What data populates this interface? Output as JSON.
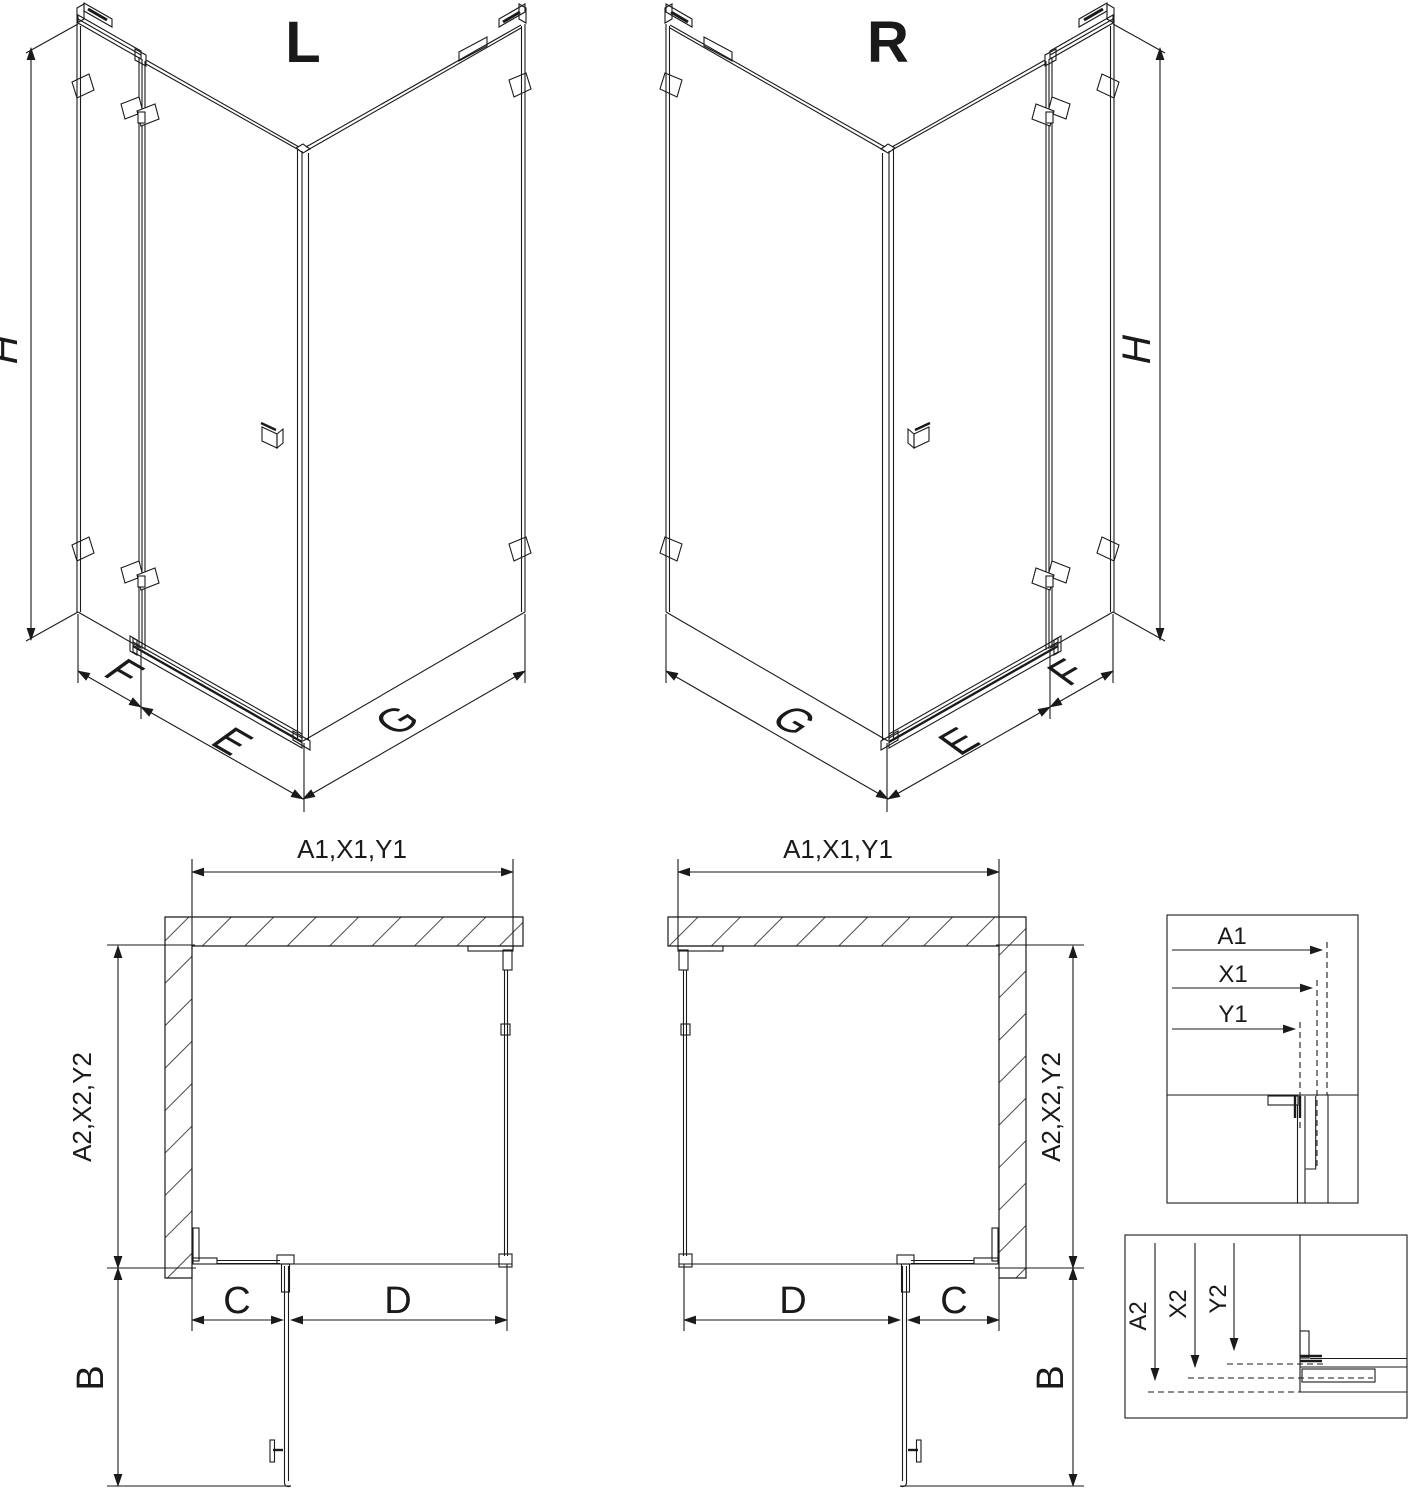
{
  "drawing": {
    "left_view_label": "L",
    "right_view_label": "R",
    "dim_height": "H",
    "dim_fixed_panel": "F",
    "dim_door": "E",
    "dim_side_panel": "G",
    "plan_width_group": "A1,X1,Y1",
    "plan_depth_group": "A2,X2,Y2",
    "dim_c": "C",
    "dim_d": "D",
    "dim_b": "B",
    "detail_a1": "A1",
    "detail_x1": "X1",
    "detail_y1": "Y1",
    "detail_a2": "A2",
    "detail_x2": "X2",
    "detail_y2": "Y2"
  },
  "colors": {
    "line": "#1a1a1a",
    "background": "#ffffff"
  }
}
